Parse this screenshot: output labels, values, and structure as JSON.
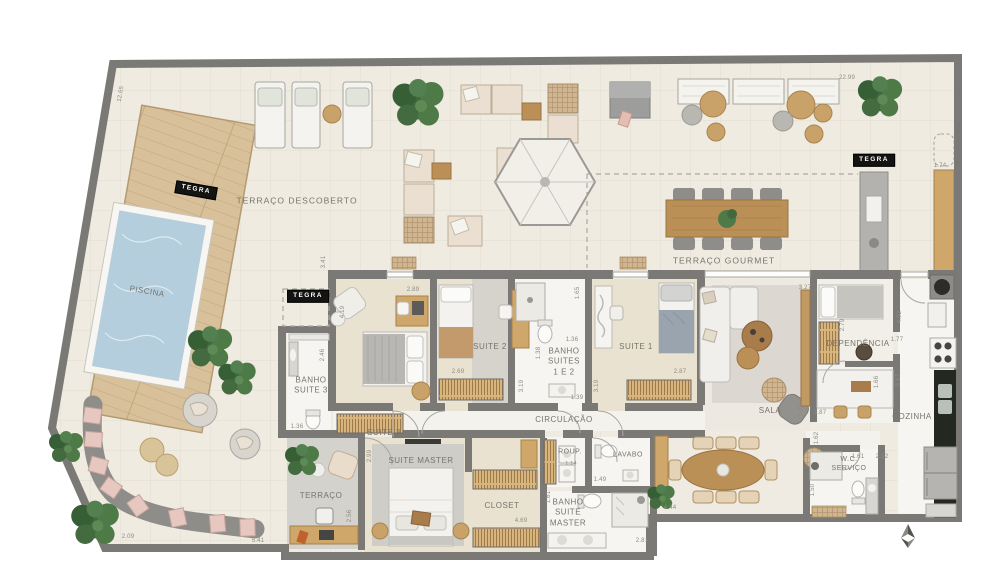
{
  "brand": {
    "logo": "TEGRA"
  },
  "rooms": {
    "terraco_descoberto": "TERRAÇO DESCOBERTO",
    "piscina": "PISCINA",
    "terraco_gourmet": "TERRAÇO GOURMET",
    "banho_suite3": "BANHO\nSUITE 3",
    "suite3": "SUITE 3",
    "suite2": "SUITE 2",
    "banho_suites12": "BANHO\nSUITES\n1 E 2",
    "suite1": "SUITE 1",
    "circulacao": "CIRCULAÇÃO",
    "sala": "SALA",
    "dependencia": "DEPENDÊNCIA",
    "cozinha": "COZINHA",
    "terraco": "TERRAÇO",
    "suite_master": "SUITE MASTER",
    "closet": "CLOSET",
    "banho_suite_master": "BANHO\nSUITE\nMASTER",
    "roup": "ROUP.",
    "lavabo": "LAVABO",
    "wc_servico": "W.C.\nSERVIÇO"
  },
  "dims": {
    "terrace_left": "12.65",
    "gourmet_top": "22.99",
    "gourmet_counter": "1.74",
    "suite3_top": "3.41",
    "suite3_desk": "2.89",
    "suite3_left": "4.19",
    "banho3_height": "2.46",
    "banho3_width": "1.36",
    "suite2_wardrobe": "2.69",
    "banho12_top": "1.65",
    "banho12_width": "1.36",
    "banho12_left": "1.38",
    "banho12_door": "1.39",
    "circ_left": "3.19",
    "circ_right": "3.19",
    "suite1_wardrobe": "2.87",
    "sala_top": "3.27",
    "dep_wardrobe": "2.79",
    "kitchen_top": "4.92",
    "kitchen_pass": "1.77",
    "dep_bottom": "1.66",
    "kitchen_side": "5.17",
    "kitchen_table": "3.87",
    "sala_right": "6.25",
    "hall_right": "1.62",
    "suite_master_left": "2.99",
    "terraco_right": "2.56",
    "bottom_left": "5.41",
    "sofa_width": "2.09",
    "closet_width": "4.69",
    "banho_master_left": "1.61",
    "banho_master_bottom": "2.81",
    "roup_width": "1.14",
    "roup_door": "1.49",
    "dining_bottom": "4.44",
    "wc_width_a": "1.61",
    "wc_width_b": "2.12",
    "wc_left": "1.50"
  }
}
